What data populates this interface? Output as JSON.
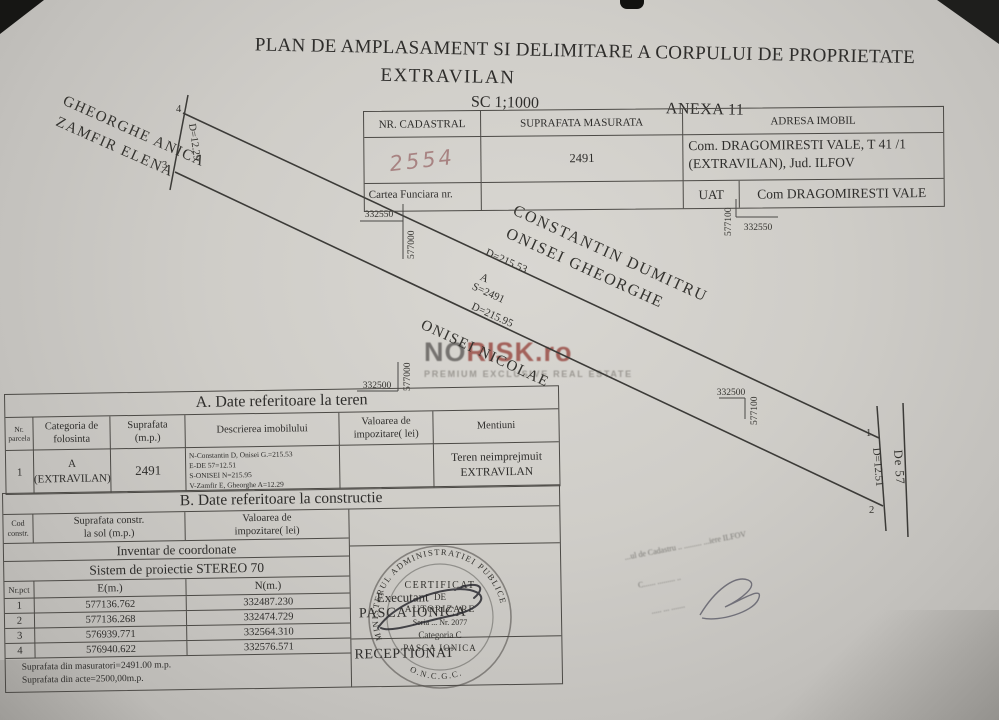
{
  "title": {
    "line1": "PLAN DE AMPLASAMENT SI DELIMITARE A CORPULUI DE PROPRIETATE",
    "line2": "EXTRAVILAN",
    "scale": "SC 1;1000",
    "anexa": "ANEXA 11"
  },
  "property_table": {
    "headers": [
      "NR. CADASTRAL",
      "SUPRAFATA MASURATA",
      "ADRESA IMOBIL"
    ],
    "nr_cadastral_handwritten": "2554",
    "suprafata_masurata": "2491",
    "adresa_line1": "Com. DRAGOMIRESTI VALE, T 41 /1",
    "adresa_line2": "(EXTRAVILAN), Jud. ILFOV",
    "cartea_funciara_label": "Cartea Funciara nr.",
    "uat_label": "UAT",
    "uat_value": "Com DRAGOMIRESTI VALE"
  },
  "drawing": {
    "neighbor_nw_line1": "GHEORGHE ANICA",
    "neighbor_nw_line2": "ZAMFIR ELENA",
    "neighbor_n_line1": "CONSTANTIN DUMITRU",
    "neighbor_n_line2": "ONISEI GHEORGHE",
    "neighbor_s": "ONISEI NICOLAE",
    "road_label": "De 57",
    "dim_west": "D=12.29",
    "dim_north": "D=215.53",
    "parcel_letter": "A",
    "parcel_area": "S=2491",
    "dim_south": "D=215.95",
    "dim_east": "D=12.51",
    "points": {
      "p1": "1",
      "p2": "2",
      "p3": "3",
      "p4": "4"
    },
    "grid_crosses": {
      "top_left": {
        "x_label": "332550",
        "y_label": "577000"
      },
      "top_right": {
        "x_label": "332550",
        "y_label": "577100"
      },
      "bottom_left": {
        "x_label": "332500",
        "y_label": "577000"
      },
      "bottom_right": {
        "x_label": "332500",
        "y_label": "577100"
      }
    }
  },
  "watermark": {
    "logo_part1": "NO",
    "logo_part2": "RISK",
    "logo_part3": ".ro",
    "tagline": "PREMIUM EXCLUSIVE REAL ESTATE"
  },
  "table_a": {
    "title": "A. Date referitoare la teren",
    "headers": {
      "nr_line1": "Nr.",
      "nr_line2": "parcela",
      "categoria": "Categoria de folosinta",
      "suprafata_line1": "Suprafata",
      "suprafata_line2": "(m.p.)",
      "descriere": "Descrierea imobilului",
      "valoare_line1": "Valoarea de",
      "valoare_line2": "impozitare( lei)",
      "mentiuni": "Mentiuni"
    },
    "row": {
      "nr": "1",
      "categoria_line1": "A",
      "categoria_line2": "(EXTRAVILAN)",
      "suprafata": "2491",
      "descriere_lines": [
        "N-Constantin D, Onisei G.=215.53",
        "E-DE 57=12.51",
        "S-ONISEI N=215.95",
        "V-Zamfir E, Gheorghe A=12.29"
      ],
      "valoare": "",
      "mentiuni_line1": "Teren neimprejmuit",
      "mentiuni_line2": "EXTRAVILAN"
    }
  },
  "table_b": {
    "title": "B. Date referitoare la constructie",
    "headers": {
      "cod_line1": "Cod",
      "cod_line2": "constr.",
      "suprafata_line1": "Suprafata constr.",
      "suprafata_line2": "la sol (m.p.)",
      "valoare_line1": "Valoarea de",
      "valoare_line2": "impozitare( lei)"
    }
  },
  "coordinates": {
    "title": "Inventar de coordonate",
    "system": "Sistem de proiectie STEREO 70",
    "headers": [
      "Nr.pct",
      "E(m.)",
      "N(m.)"
    ],
    "rows": [
      [
        "1",
        "577136.762",
        "332487.230"
      ],
      [
        "2",
        "577136.268",
        "332474.729"
      ],
      [
        "3",
        "576939.771",
        "332564.310"
      ],
      [
        "4",
        "576940.622",
        "332576.571"
      ]
    ]
  },
  "notes": {
    "line1": "Suprafata din masuratori=2491.00 m.p.",
    "line2": "Suprafata din acte=2500,00m.p."
  },
  "signatures": {
    "executant_label": "Executant",
    "executant_name": "PASCA IONICA",
    "receptionat_label": "RECEPTIONAT"
  },
  "stamp": {
    "arc_top": "MINISTERUL ADMINISTRATIEI PUBLICE",
    "arc_bottom": "O.N.C.G.C.",
    "line1": "CERTIFICAT",
    "line2": "DE",
    "line3": "AUTORIZARE",
    "line4": "Seria ... Nr. 2077",
    "line5": "Categoria C",
    "line6": "PASCA IONICA"
  },
  "faint_stamp": {
    "line1": "...ul de Cadastru .. ......... ...iere ILFOV",
    "line2": "C......  .........  ..",
    "line3": ".....  ...  ......."
  }
}
